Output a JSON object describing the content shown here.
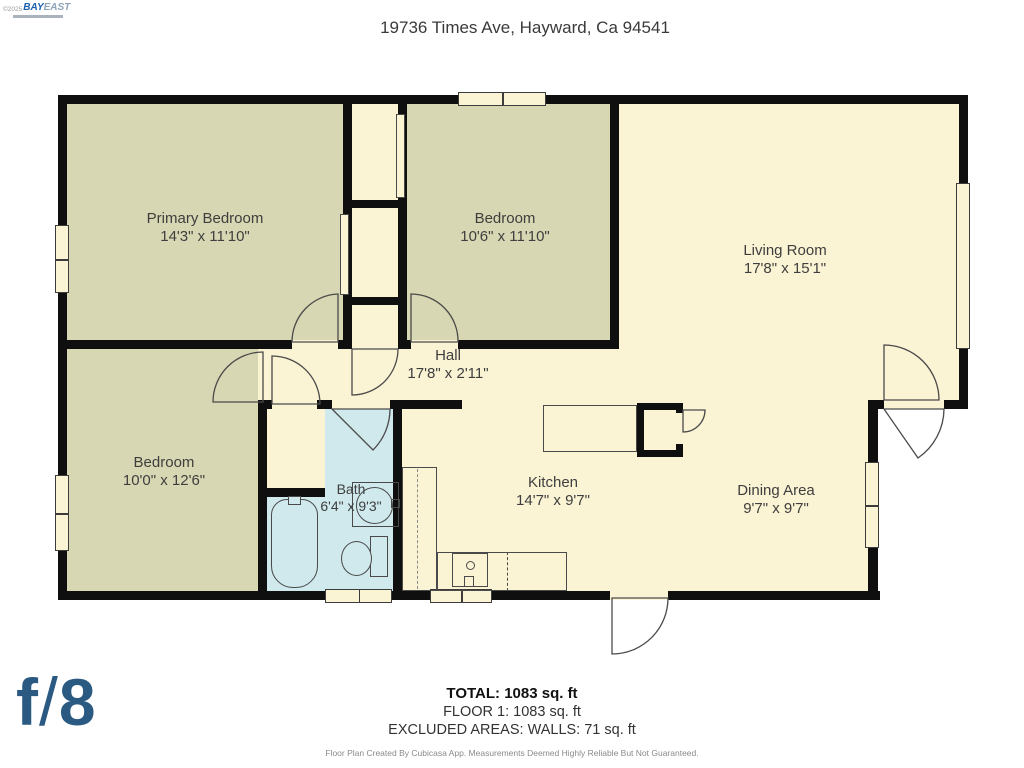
{
  "watermark": {
    "copyright": "©2025",
    "brand_primary": "BAY",
    "brand_secondary": "EAST"
  },
  "title": "19736 Times Ave, Hayward, Ca 94541",
  "rooms": [
    {
      "id": "primary-bedroom",
      "name": "Primary Bedroom",
      "dims": "14'3\" x 11'10\""
    },
    {
      "id": "bedroom-top",
      "name": "Bedroom",
      "dims": "10'6\" x 11'10\""
    },
    {
      "id": "living-room",
      "name": "Living Room",
      "dims": "17'8\" x 15'1\""
    },
    {
      "id": "hall",
      "name": "Hall",
      "dims": "17'8\" x 2'11\""
    },
    {
      "id": "bedroom-left",
      "name": "Bedroom",
      "dims": "10'0\" x 12'6\""
    },
    {
      "id": "bath",
      "name": "Bath",
      "dims": "6'4\" x 9'3\""
    },
    {
      "id": "kitchen",
      "name": "Kitchen",
      "dims": "14'7\" x 9'7\""
    },
    {
      "id": "dining-area",
      "name": "Dining Area",
      "dims": "9'7\" x 9'7\""
    }
  ],
  "summary": {
    "total": "TOTAL: 1083 sq. ft",
    "floor": "FLOOR 1: 1083 sq. ft",
    "excluded": "EXCLUDED AREAS: WALLS: 71 sq. ft",
    "disclaimer": "Floor Plan Created By Cubicasa App. Measurements Deemed Highly Reliable But Not Guaranteed."
  },
  "logo": {
    "f": "f",
    "slash": "/",
    "eight": "8"
  },
  "colors": {
    "room_cream": "#faf3d4",
    "room_khaki": "#d8d7b3",
    "room_bath_blue": "#cfe9ed",
    "wall_black": "#0f0f0f",
    "logo_blue": "#2a5a82",
    "brand_blue": "#1b5fae"
  }
}
